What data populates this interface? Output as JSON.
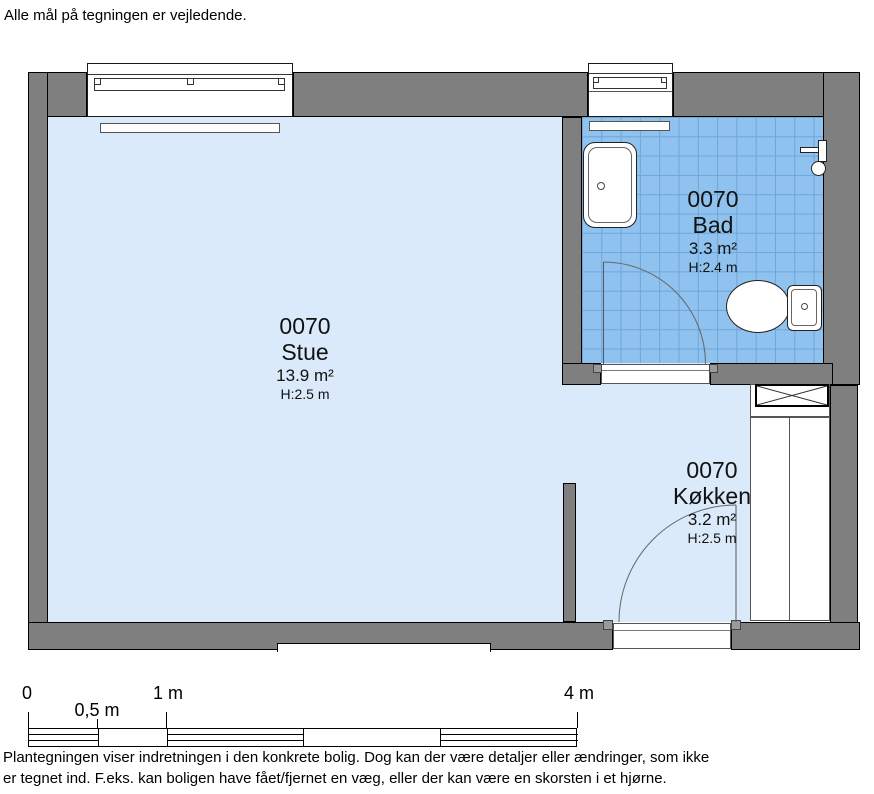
{
  "page": {
    "disclaimer_top": "Alle mål på tegningen er vejledende.",
    "footer_line1": "Plantegningen viser indretningen i den konkrete bolig. Dog kan der være detaljer eller ændringer, som ikke",
    "footer_line2": "er tegnet ind. F.eks. kan boligen have fået/fjernet en væg, eller der kan være en skorsten i et hjørne."
  },
  "floor_plan": {
    "rooms": [
      {
        "id": "0070",
        "name": "Stue",
        "area": "13.9 m²",
        "ceiling_height": "H:2.5 m"
      },
      {
        "id": "0070",
        "name": "Bad",
        "area": "3.3 m²",
        "ceiling_height": "H:2.4 m"
      },
      {
        "id": "0070",
        "name": "Køkken",
        "area": "3.2 m²",
        "ceiling_height": "H:2.5 m"
      }
    ],
    "fixture_icons": [
      "window-icon",
      "radiator-icon",
      "sink-icon",
      "shower-icon",
      "toilet-icon",
      "duct-shaft-x-icon",
      "door-swing-arc-icon"
    ],
    "colors": {
      "wall_fill": "#7f7f7f",
      "wall_outline": "#000000",
      "floor_fill": "#daeafa",
      "bath_tile_fill": "#8fc2ee",
      "bath_tile_grid": "#6da6d9"
    }
  },
  "scale_bar": {
    "labels": [
      "0",
      "0,5 m",
      "1 m",
      "4 m"
    ]
  }
}
